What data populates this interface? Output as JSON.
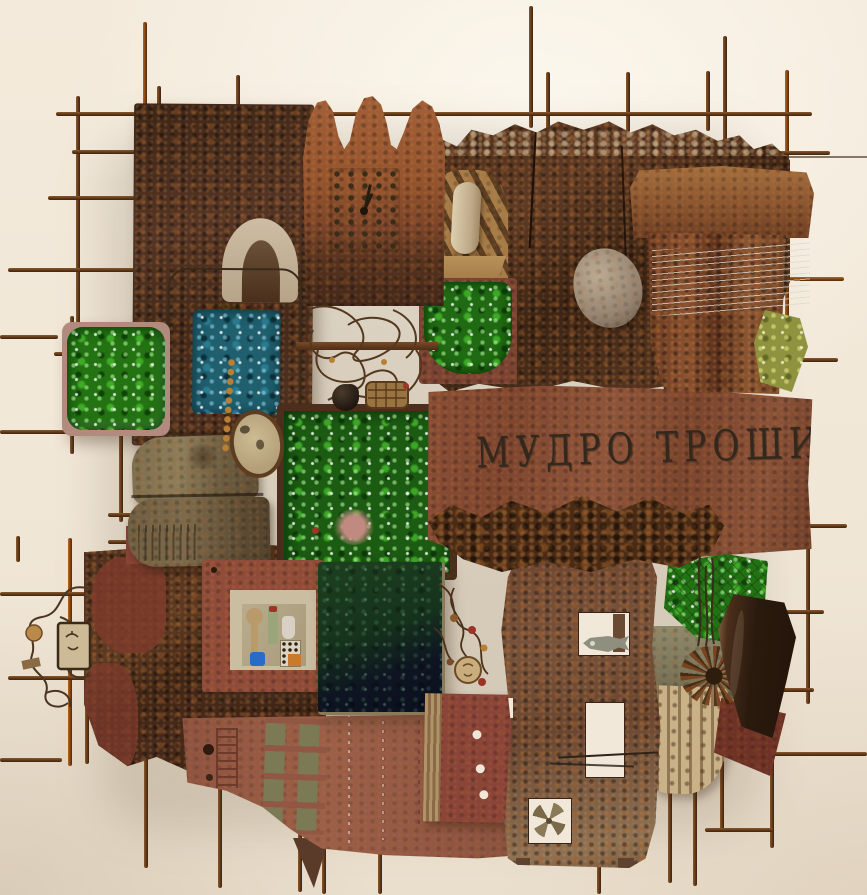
{
  "artwork": {
    "title": "Mixed-media wall assemblage of rusted metal, crushed glass and wire",
    "inscription": "МУДРО ТРОШИ"
  },
  "palette": {
    "wall": "#f2e8d9",
    "rust_dark": "#422817",
    "rust_mid": "#6e4226",
    "rust_orange": "#9a5a2e",
    "brick_red": "#8e4a38",
    "flap_red": "#935741",
    "glass_green": "#237312",
    "glass_teal": "#1f5f6e",
    "glass_bottle_dark": "#13301b",
    "glass_olive": "#8f9340",
    "bone_beige": "#c9b795",
    "wire_gray": "#d8d4ca",
    "rod_rust": "#6b4220"
  },
  "elements": [
    {
      "name": "rebar-grid",
      "desc": "rusted steel rod lattice extending beyond the collage"
    },
    {
      "name": "crown-relic",
      "desc": "crown-shaped rusted plate holding a riveted clock face"
    },
    {
      "name": "inscription-board",
      "desc": "clay board carved with Cyrillic capitals"
    },
    {
      "name": "tower-cutout",
      "desc": "tapered metal tower with window openings, fish relief and pinwheel"
    },
    {
      "name": "green-glass-tiles",
      "desc": "crushed green glass panels in rusted frames"
    },
    {
      "name": "teal-glass-panel",
      "desc": "blue-green glass with hanging amber bead string"
    },
    {
      "name": "wire-tangle",
      "desc": "nest of rusted wire with a small woven basket"
    },
    {
      "name": "strung-vessel",
      "desc": "pot shard strung with fine steel wires"
    },
    {
      "name": "leather-flap",
      "desc": "red-brown hide drawn with ladder and grid patterns"
    },
    {
      "name": "collage-frame",
      "desc": "red frame holding a miniature painted still-life"
    },
    {
      "name": "canteen",
      "desc": "crushed olive metal flask"
    },
    {
      "name": "stone",
      "desc": "embedded grey pebble"
    },
    {
      "name": "wire-spiral",
      "desc": "looping wire ornament with bead and tiny icon"
    }
  ]
}
